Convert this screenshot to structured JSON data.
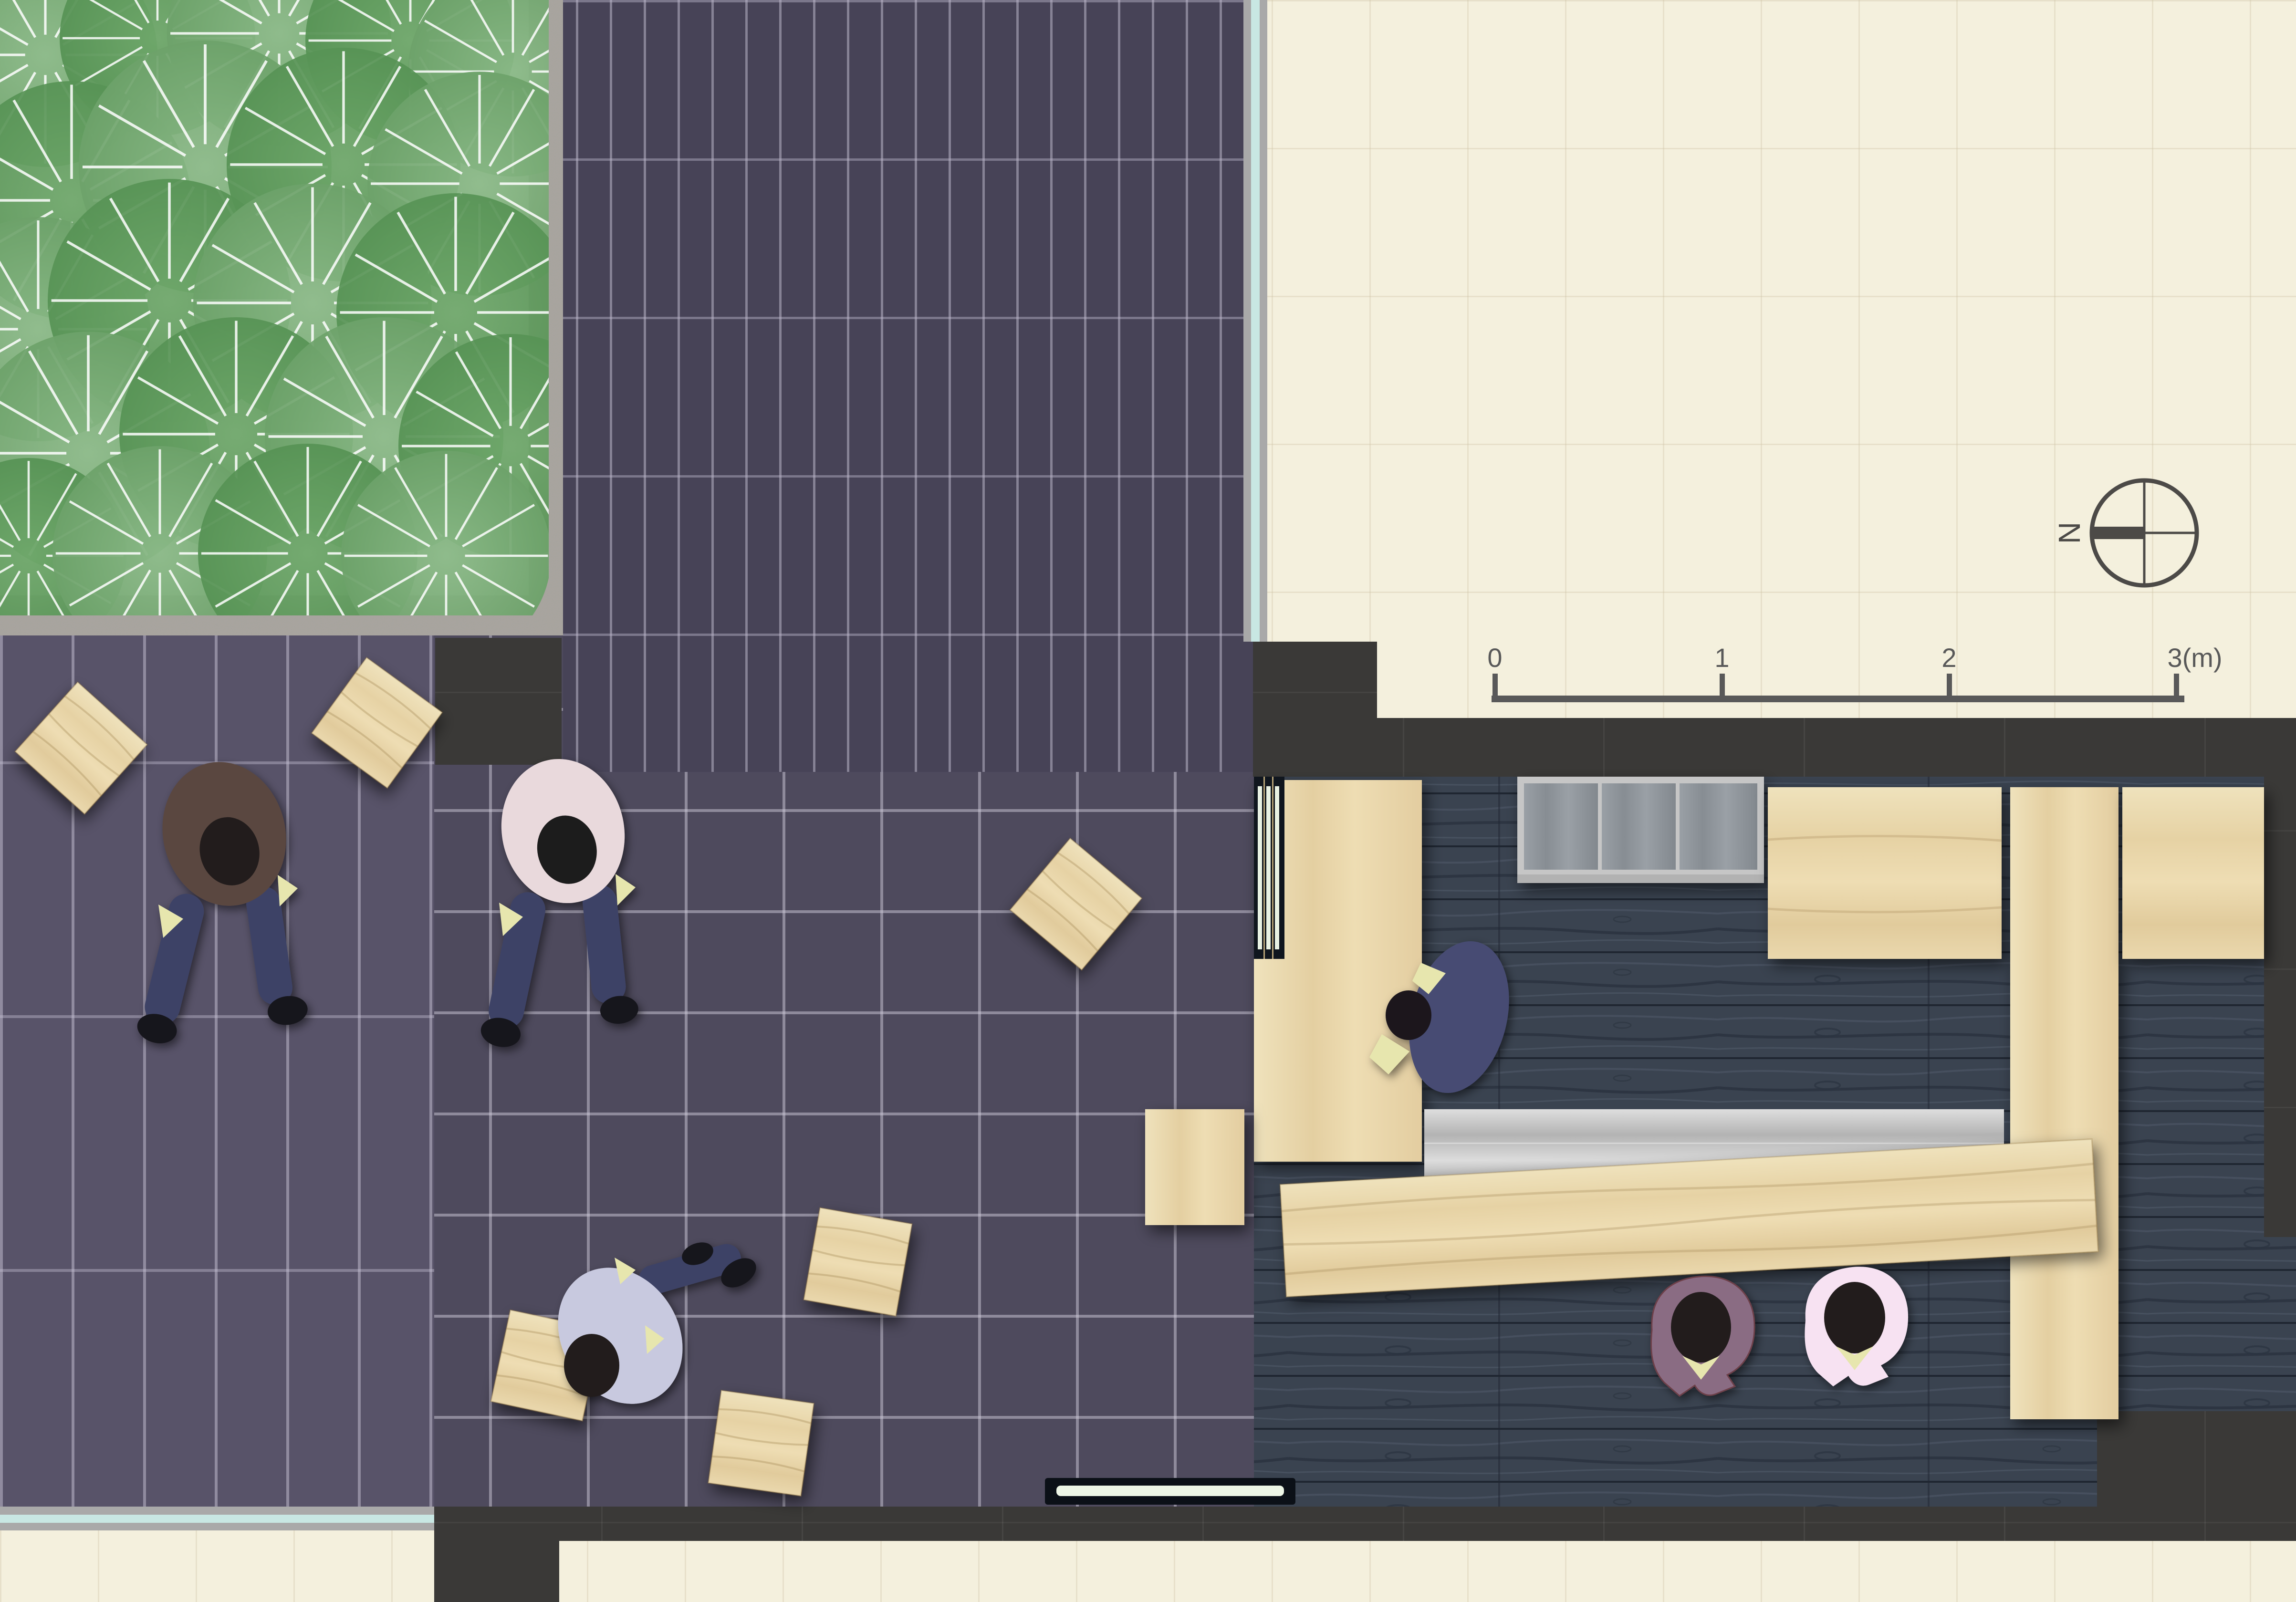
{
  "document": {
    "kind": "architectural plan, top-down view of paved courtyard with planting bed and cafe interior"
  },
  "compass": {
    "label": "N"
  },
  "scale_bar": {
    "tick_labels": [
      "0",
      "1",
      "2",
      "3(m)"
    ]
  },
  "palette": {
    "cream_mat": "#f4f0dd",
    "plaza_tile_center": "#4e4a5d",
    "plaza_tile_top": "#474357",
    "plaza_tile_left": "#585369",
    "wall_charcoal": "#3a3937",
    "interior_plank": "#3a4350",
    "light_wood": "#e8d5a9",
    "stainless": "#c0c0c0",
    "glass_line": "#c8e7e3",
    "shrub_light": "#7fae7c",
    "shrub_dark": "#639a5f",
    "gravel": "#f3f2ed",
    "concrete": "#a6a29c",
    "floor_light_strip": "#edf6e6",
    "annotation": "#4c4a47"
  },
  "areas": [
    "planting-bed",
    "gravel-bed",
    "concrete-border",
    "upper-tile-paving",
    "left-tile-paving",
    "central-tile-plaza",
    "tatami-cream-court",
    "interior-wood-floor",
    "glass-facade-line",
    "charcoal-walls"
  ],
  "people": [
    {
      "id": "walker-brown",
      "shirt": "#5a4741"
    },
    {
      "id": "walker-pink",
      "shirt": "#e9d9dc"
    },
    {
      "id": "walker-lavender",
      "shirt": "#c8c9df"
    },
    {
      "id": "sitter-navy-at-counter",
      "shirt": "#474c73"
    },
    {
      "id": "sitter-purple-at-table",
      "shirt": "#8a6c83"
    },
    {
      "id": "sitter-pink-at-table",
      "shirt": "#f7e2f2"
    }
  ],
  "furniture": [
    "service-counter",
    "slatted-bench",
    "grill-cabinet",
    "upper-counter",
    "island-plank-counter",
    "wall-counter",
    "stainless-table",
    "low-table",
    "bench-cube",
    "wood-stools",
    "floor-light-strip"
  ]
}
